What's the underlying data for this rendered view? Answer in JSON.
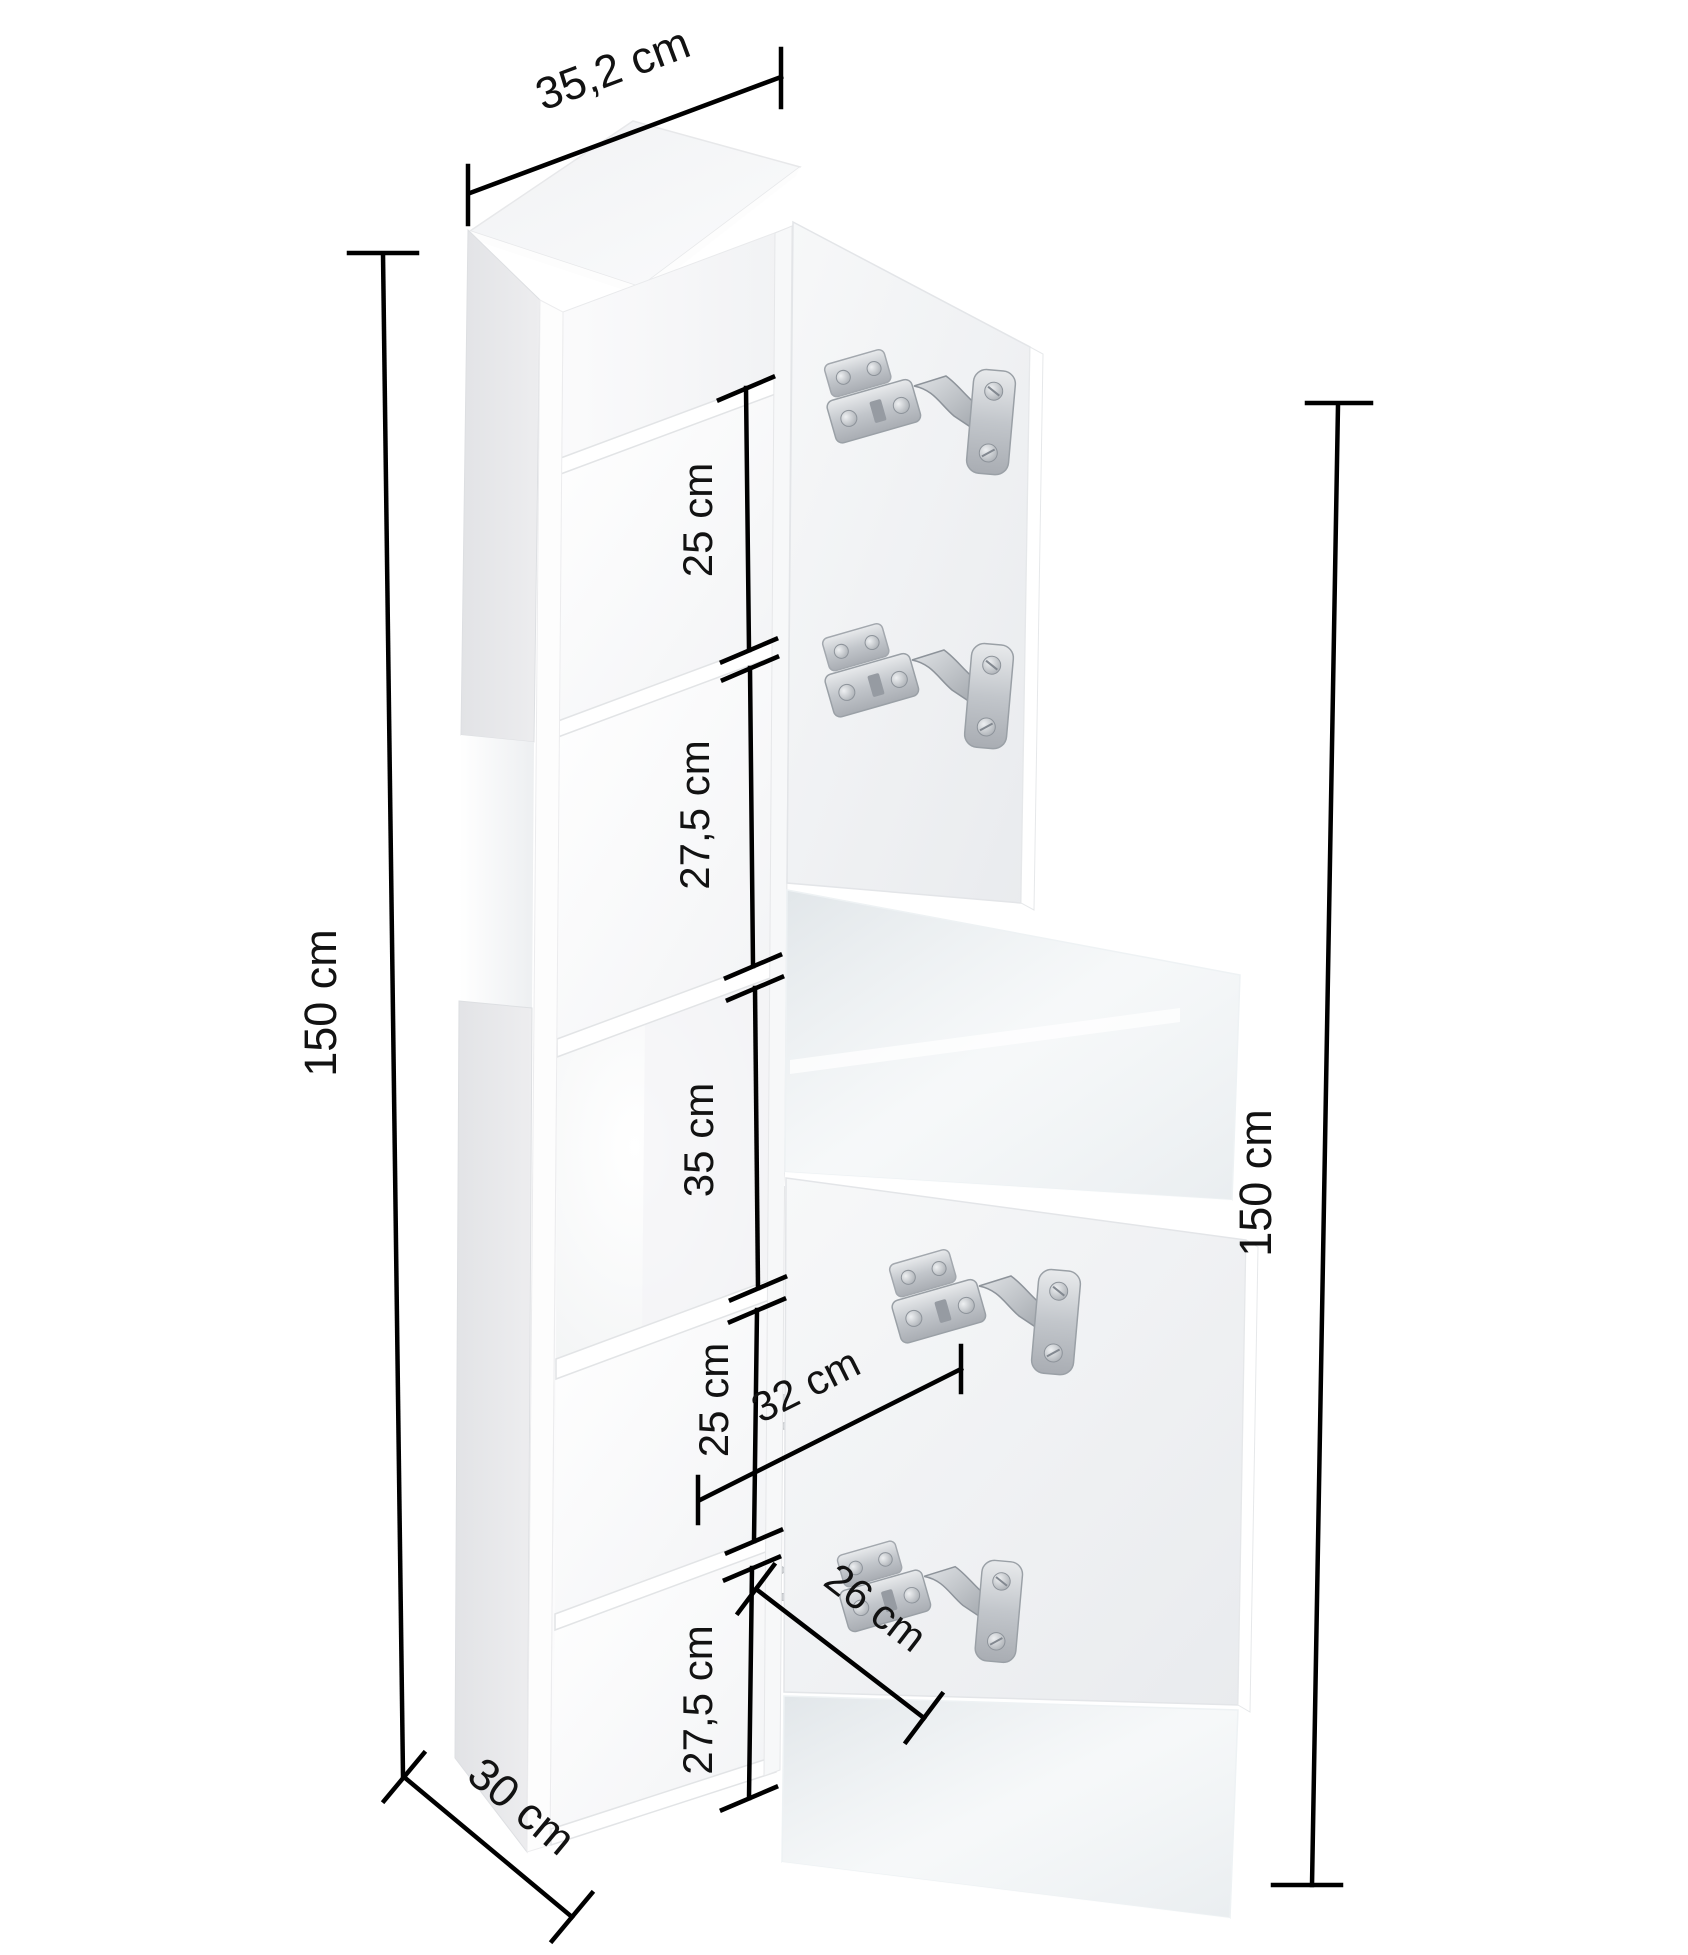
{
  "diagram": {
    "type": "furniture-dimension-diagram",
    "subject": "tall cabinet with two open doors, open middle niche and four concealed hinges",
    "dims": {
      "top_width": "35,2 cm",
      "left_height": "150 cm",
      "right_height": "150 cm",
      "depth": "30 cm",
      "inner_width_upper": "32 cm",
      "inner_width_lower": "26 cm",
      "compartments": [
        "25 cm",
        "27,5 cm",
        "35 cm",
        "25 cm",
        "27,5 cm"
      ]
    },
    "hardware": {
      "hinge_count": 4
    },
    "colors": {
      "background": "#ffffff",
      "dimension_lines": "#000000",
      "side_panel": "#e6e7e9",
      "door_front": "#f2f3f5",
      "glass_front": "#ccd5da",
      "hinge_metal": "#c3c7cc"
    }
  }
}
